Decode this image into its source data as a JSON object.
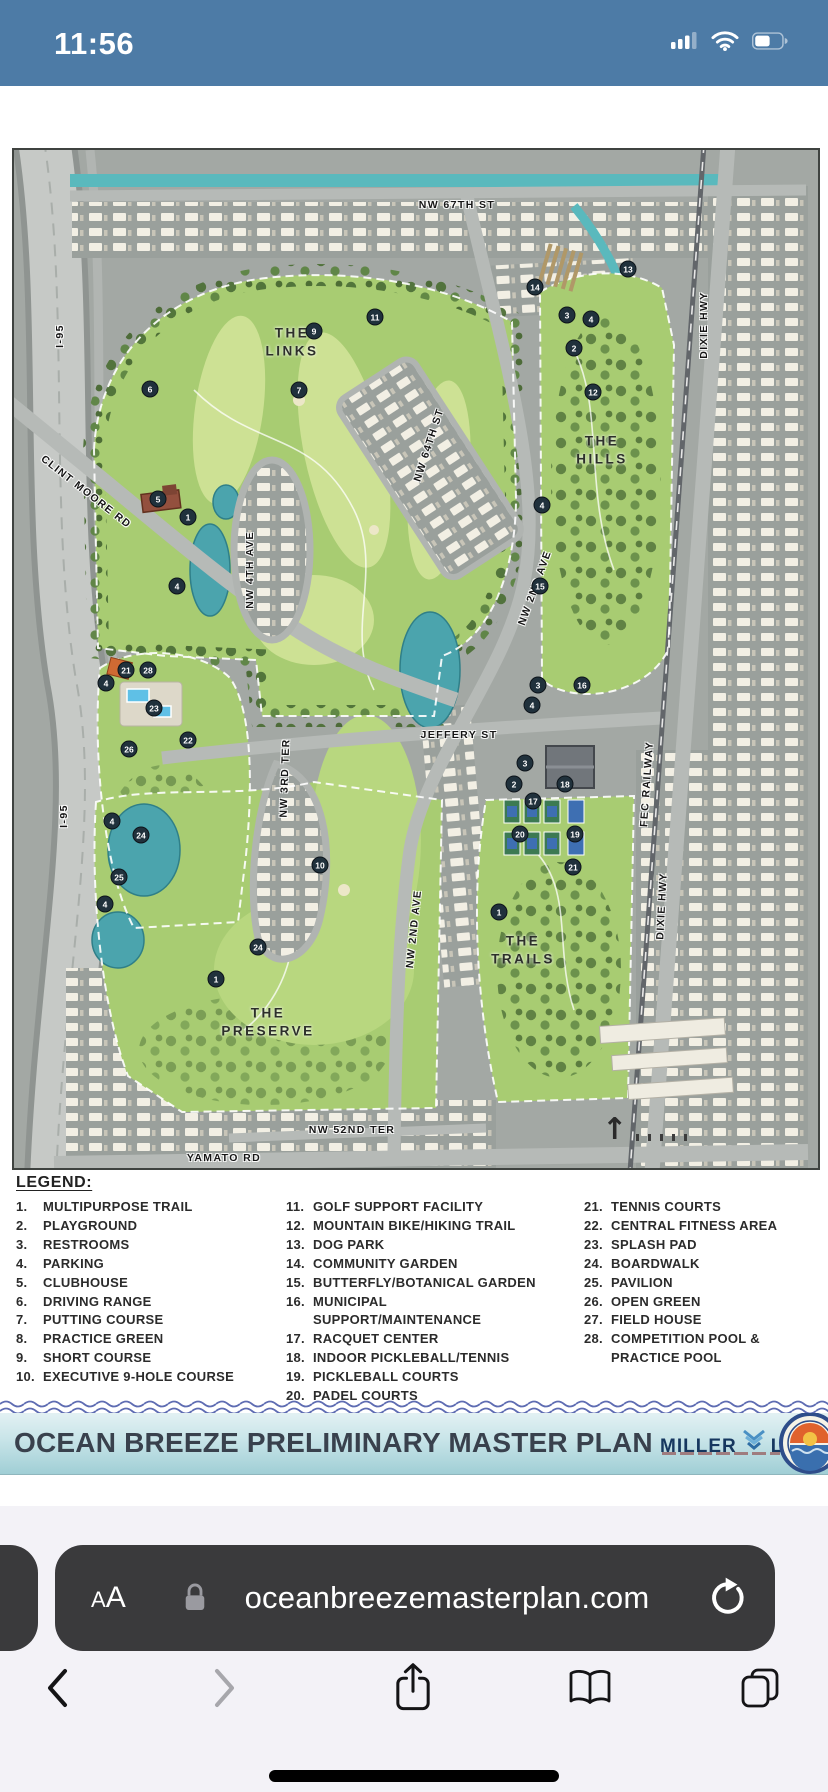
{
  "status": {
    "time": "11:56"
  },
  "map": {
    "north_arrow": "↑",
    "streets": [
      {
        "label": "NW 67TH ST",
        "x": 443,
        "y": 55,
        "rot": 0
      },
      {
        "label": "I-95",
        "x": 46,
        "y": 186,
        "rot": -90
      },
      {
        "label": "CLINT MOORE RD",
        "x": 72,
        "y": 342,
        "rot": 38
      },
      {
        "label": "NW 4TH AVE",
        "x": 236,
        "y": 420,
        "rot": -90
      },
      {
        "label": "NW 64TH ST",
        "x": 415,
        "y": 295,
        "rot": -72
      },
      {
        "label": "NW 2ND AVE",
        "x": 521,
        "y": 438,
        "rot": -70
      },
      {
        "label": "JEFFERY ST",
        "x": 445,
        "y": 585,
        "rot": 0
      },
      {
        "label": "NW 3RD TER",
        "x": 271,
        "y": 628,
        "rot": -88
      },
      {
        "label": "FEC RAILWAY",
        "x": 633,
        "y": 634,
        "rot": -86
      },
      {
        "label": "DIXIE HWY",
        "x": 690,
        "y": 175,
        "rot": -90
      },
      {
        "label": "DIXIE HWY",
        "x": 648,
        "y": 756,
        "rot": -87
      },
      {
        "label": "I-95",
        "x": 50,
        "y": 666,
        "rot": -90
      },
      {
        "label": "NW 2ND AVE",
        "x": 400,
        "y": 779,
        "rot": -84
      },
      {
        "label": "NW 52ND TER",
        "x": 338,
        "y": 980,
        "rot": 0
      },
      {
        "label": "YAMATO RD",
        "x": 210,
        "y": 1008,
        "rot": 0
      }
    ],
    "areas": [
      {
        "label": "THE\nLINKS",
        "x": 278,
        "y": 192
      },
      {
        "label": "THE\nHILLS",
        "x": 588,
        "y": 300
      },
      {
        "label": "THE\nTRAILS",
        "x": 509,
        "y": 800
      },
      {
        "label": "THE\nPRESERVE",
        "x": 254,
        "y": 872
      }
    ],
    "markers": [
      {
        "n": "6",
        "x": 136,
        "y": 239
      },
      {
        "n": "9",
        "x": 300,
        "y": 181
      },
      {
        "n": "11",
        "x": 361,
        "y": 167
      },
      {
        "n": "7",
        "x": 285,
        "y": 240
      },
      {
        "n": "5",
        "x": 144,
        "y": 349
      },
      {
        "n": "1",
        "x": 174,
        "y": 367
      },
      {
        "n": "4",
        "x": 163,
        "y": 436
      },
      {
        "n": "14",
        "x": 521,
        "y": 137
      },
      {
        "n": "13",
        "x": 614,
        "y": 119
      },
      {
        "n": "3",
        "x": 553,
        "y": 165
      },
      {
        "n": "4",
        "x": 577,
        "y": 169
      },
      {
        "n": "2",
        "x": 560,
        "y": 198
      },
      {
        "n": "12",
        "x": 579,
        "y": 242
      },
      {
        "n": "4",
        "x": 528,
        "y": 355
      },
      {
        "n": "15",
        "x": 526,
        "y": 436
      },
      {
        "n": "3",
        "x": 524,
        "y": 535
      },
      {
        "n": "16",
        "x": 568,
        "y": 535
      },
      {
        "n": "4",
        "x": 518,
        "y": 555
      },
      {
        "n": "4",
        "x": 92,
        "y": 533
      },
      {
        "n": "21",
        "x": 112,
        "y": 520
      },
      {
        "n": "28",
        "x": 134,
        "y": 520
      },
      {
        "n": "23",
        "x": 140,
        "y": 558
      },
      {
        "n": "22",
        "x": 174,
        "y": 590
      },
      {
        "n": "26",
        "x": 115,
        "y": 599
      },
      {
        "n": "4",
        "x": 98,
        "y": 671
      },
      {
        "n": "24",
        "x": 127,
        "y": 685
      },
      {
        "n": "25",
        "x": 105,
        "y": 727
      },
      {
        "n": "4",
        "x": 91,
        "y": 754
      },
      {
        "n": "10",
        "x": 306,
        "y": 715
      },
      {
        "n": "24",
        "x": 244,
        "y": 797
      },
      {
        "n": "1",
        "x": 202,
        "y": 829
      },
      {
        "n": "3",
        "x": 511,
        "y": 613
      },
      {
        "n": "2",
        "x": 500,
        "y": 634
      },
      {
        "n": "18",
        "x": 551,
        "y": 634
      },
      {
        "n": "17",
        "x": 519,
        "y": 651
      },
      {
        "n": "20",
        "x": 506,
        "y": 684
      },
      {
        "n": "19",
        "x": 561,
        "y": 684
      },
      {
        "n": "21",
        "x": 559,
        "y": 717
      },
      {
        "n": "1",
        "x": 485,
        "y": 762
      }
    ]
  },
  "legend": {
    "title": "LEGEND:",
    "columns": [
      [
        {
          "n": "1.",
          "label": "MULTIPURPOSE TRAIL"
        },
        {
          "n": "2.",
          "label": "PLAYGROUND"
        },
        {
          "n": "3.",
          "label": "RESTROOMS"
        },
        {
          "n": "4.",
          "label": "PARKING"
        },
        {
          "n": "5.",
          "label": "CLUBHOUSE"
        },
        {
          "n": "6.",
          "label": "DRIVING RANGE"
        },
        {
          "n": "7.",
          "label": "PUTTING COURSE"
        },
        {
          "n": "8.",
          "label": "PRACTICE GREEN"
        },
        {
          "n": "9.",
          "label": "SHORT COURSE"
        },
        {
          "n": "10.",
          "label": "EXECUTIVE 9-HOLE COURSE"
        }
      ],
      [
        {
          "n": "11.",
          "label": "GOLF SUPPORT FACILITY"
        },
        {
          "n": "12.",
          "label": "MOUNTAIN BIKE/HIKING TRAIL"
        },
        {
          "n": "13.",
          "label": "DOG PARK"
        },
        {
          "n": "14.",
          "label": "COMMUNITY GARDEN"
        },
        {
          "n": "15.",
          "label": "BUTTERFLY/BOTANICAL GARDEN"
        },
        {
          "n": "16.",
          "label": "MUNICIPAL SUPPORT/MAINTENANCE"
        },
        {
          "n": "17.",
          "label": "RACQUET CENTER"
        },
        {
          "n": "18.",
          "label": "INDOOR PICKLEBALL/TENNIS"
        },
        {
          "n": "19.",
          "label": "PICKLEBALL COURTS"
        },
        {
          "n": "20.",
          "label": "PADEL COURTS"
        }
      ],
      [
        {
          "n": "21.",
          "label": "TENNIS COURTS"
        },
        {
          "n": "22.",
          "label": "CENTRAL FITNESS AREA"
        },
        {
          "n": "23.",
          "label": "SPLASH PAD"
        },
        {
          "n": "24.",
          "label": "BOARDWALK"
        },
        {
          "n": "25.",
          "label": "PAVILION"
        },
        {
          "n": "26.",
          "label": "OPEN GREEN"
        },
        {
          "n": "27.",
          "label": "FIELD HOUSE"
        },
        {
          "n": "28.",
          "label": "COMPETITION POOL &\nPRACTICE POOL"
        }
      ]
    ]
  },
  "banner": {
    "title": "OCEAN BREEZE PRELIMINARY MASTER PLAN",
    "logo_word1": "MILLER",
    "logo_word2": "LEGG"
  },
  "browser": {
    "reader_small": "A",
    "reader_large": "A",
    "url": "oceanbreezemasterplan.com"
  },
  "colors": {
    "status_bar_bg": "#4d7ba6",
    "address_bar_bg": "#3a3a3c",
    "chrome_bg": "#f3f2f7",
    "banner_text": "#39414d",
    "logo_navy": "#16375f",
    "logo_blue": "#4a90c4",
    "wave_divider": "#5e6cb2",
    "map_green": "#a8cc72",
    "map_water": "#4ba4ad",
    "map_gray": "#a3a8a4"
  }
}
